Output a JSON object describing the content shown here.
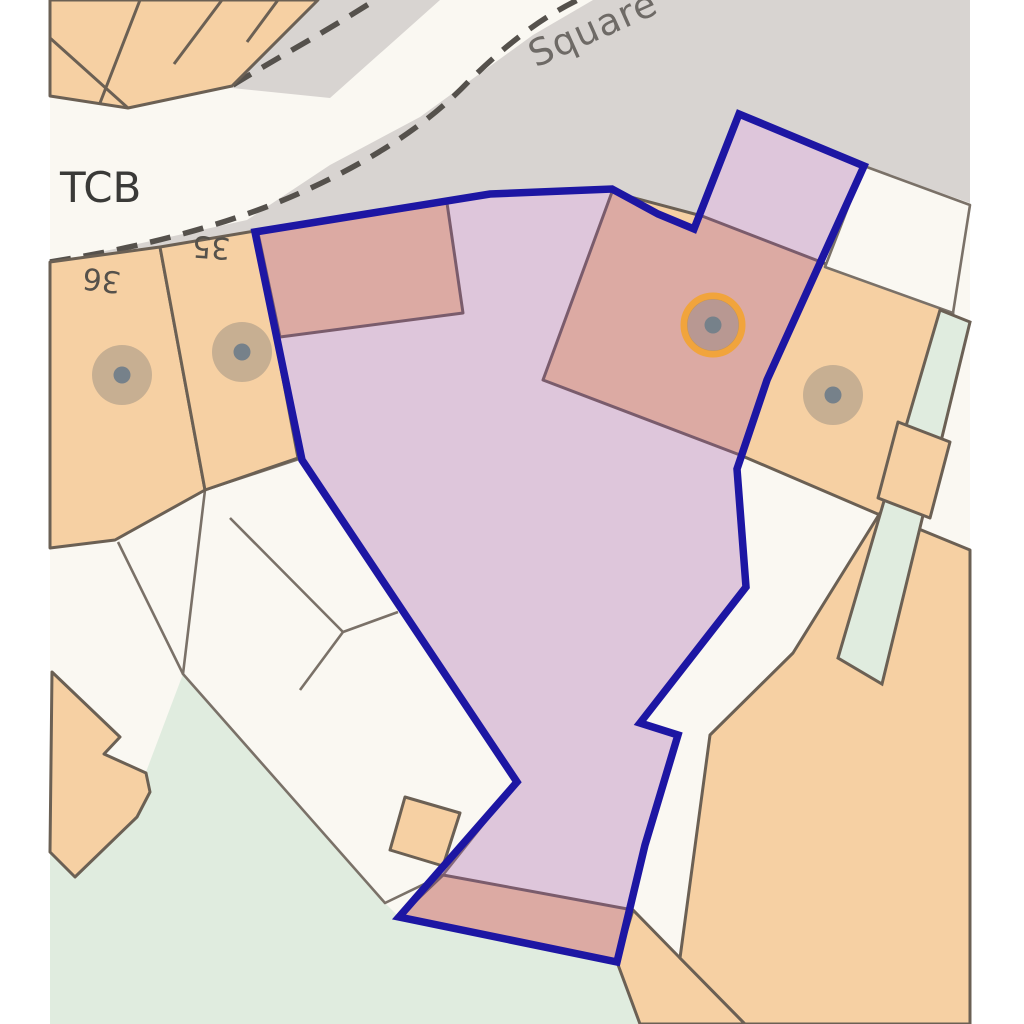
{
  "map": {
    "type": "property-boundary-plan",
    "labels": {
      "road_name": "Square",
      "tcb": "TCB",
      "house_36": "36",
      "house_35": "35"
    },
    "boundary": {
      "points": "255,232 490,194 612,189 658,214 694,229 739,114 864,166 767,380 737,469 746,587 640,723 678,735 645,845 617,962 399,917 517,782 302,460"
    },
    "markers": [
      {
        "x": 122,
        "y": 375,
        "highlighted": false
      },
      {
        "x": 242,
        "y": 352,
        "highlighted": false
      },
      {
        "x": 713,
        "y": 325,
        "highlighted": true
      },
      {
        "x": 833,
        "y": 395,
        "highlighted": false
      }
    ],
    "colors": {
      "page_background": "#ffffff",
      "map_base": "#FAF8F2",
      "road": "#D8D4D1",
      "kerb_dash": "#55514C",
      "building_fill": "#F6D0A3",
      "building_outline": "#6B6054",
      "plot_line": "#7A7168",
      "green_space": "#E0ECDF",
      "boundary_line": "#1D16A3",
      "boundary_fill": "rgba(160,82,165,0.30)",
      "marker_disc": "rgba(130,126,120,0.40)",
      "marker_dot": "#76818A",
      "marker_ring": "#F1A43C",
      "label_road": "#6E6A66",
      "label_map": "#3A3A38",
      "label_number": "#55514B"
    }
  }
}
